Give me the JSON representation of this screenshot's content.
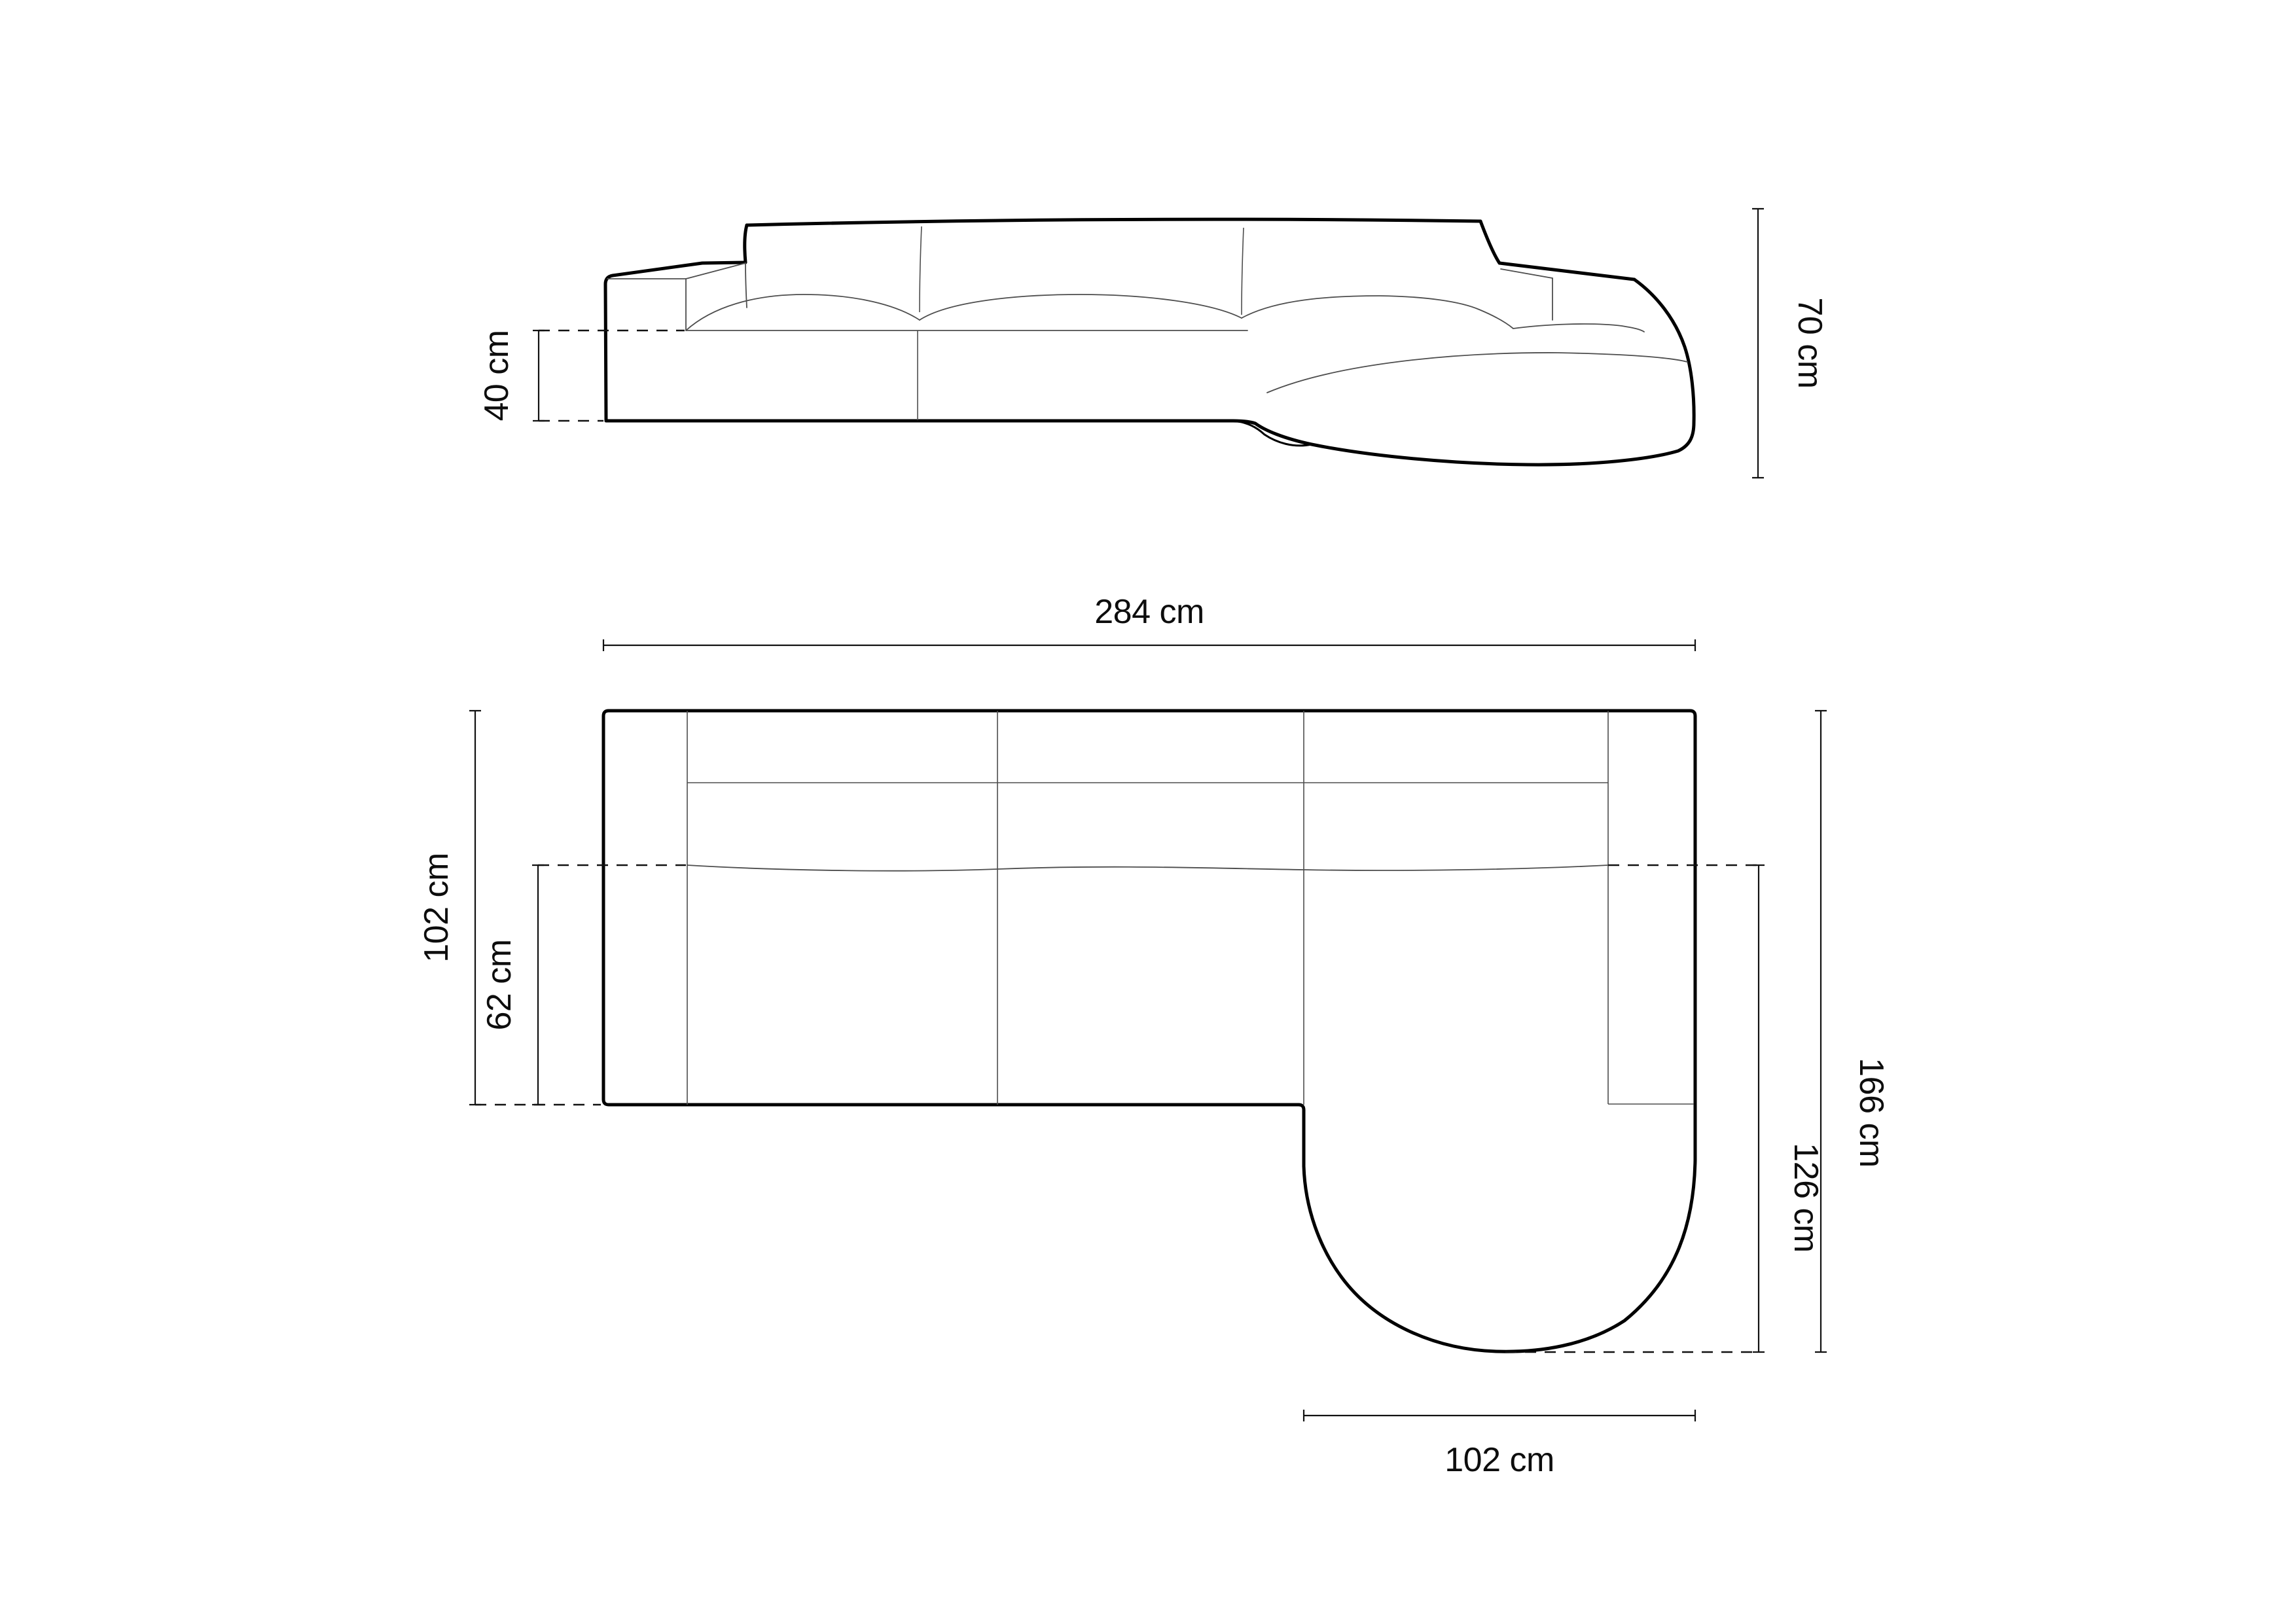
{
  "diagram_type": "furniture-dimension-drawing",
  "views": {
    "front_view": {
      "seat_height_label": "40 cm",
      "overall_height_label": "70 cm"
    },
    "plan_view": {
      "overall_width_label": "284 cm",
      "overall_depth_label": "102 cm",
      "seat_depth_label": "62 cm",
      "overall_length_label": "166 cm",
      "chaise_length_label": "126 cm",
      "chaise_width_label": "102 cm"
    }
  },
  "colors": {
    "background": "#ffffff",
    "outline": "#000000",
    "seam": "#4d4d4d",
    "dimension": "#111111"
  }
}
